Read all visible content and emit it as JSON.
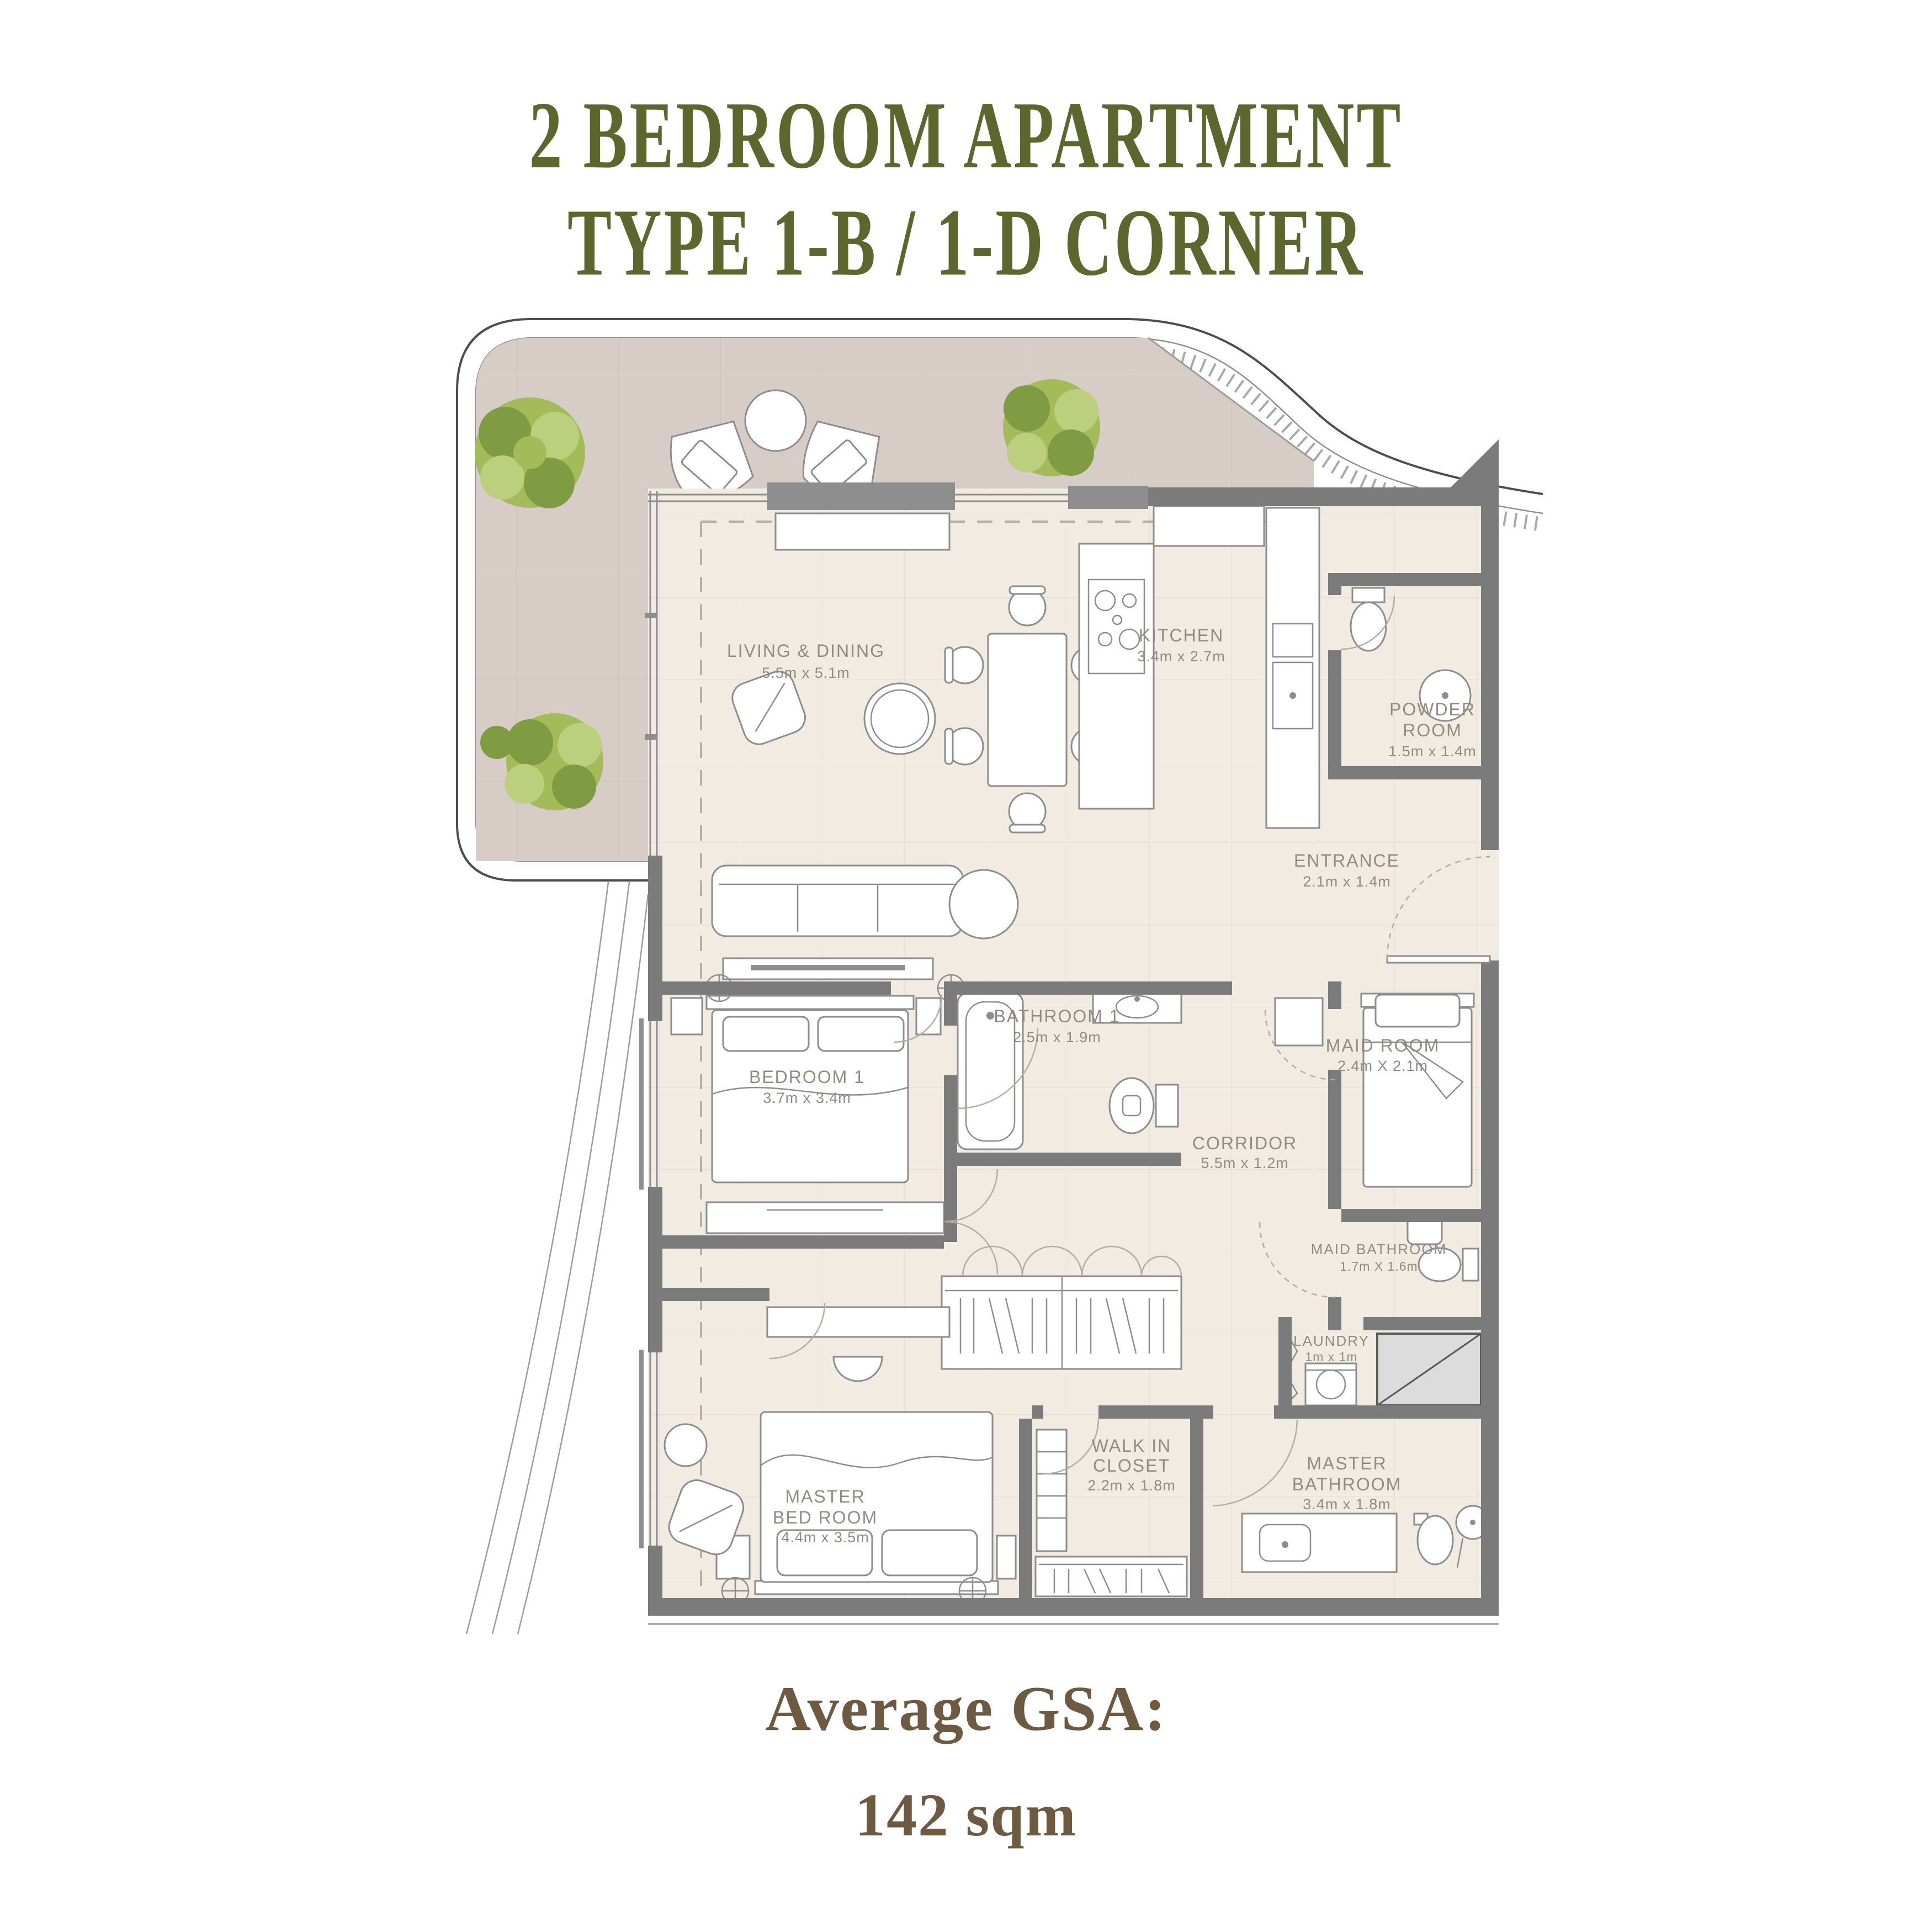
{
  "title": {
    "line1": "2 BEDROOM APARTMENT",
    "line2": "TYPE 1-B / 1-D CORNER"
  },
  "footer": {
    "label": "Average GSA:",
    "value": "142 sqm"
  },
  "rooms": [
    {
      "id": "living",
      "lines": [
        "LIVING & DINING"
      ],
      "dims": "5.5m x 5.1m"
    },
    {
      "id": "kitchen",
      "lines": [
        "KITCHEN"
      ],
      "dims": "3.4m x 2.7m"
    },
    {
      "id": "powder",
      "lines": [
        "POWDER",
        "ROOM"
      ],
      "dims": "1.5m x 1.4m"
    },
    {
      "id": "entrance",
      "lines": [
        "ENTRANCE"
      ],
      "dims": "2.1m x 1.4m"
    },
    {
      "id": "bathroom1",
      "lines": [
        "BATHROOM 1"
      ],
      "dims": "2.5m x 1.9m"
    },
    {
      "id": "bedroom1",
      "lines": [
        "BEDROOM 1"
      ],
      "dims": "3.7m x 3.4m"
    },
    {
      "id": "maidroom",
      "lines": [
        "MAID ROOM"
      ],
      "dims": "2.4m X 2.1m"
    },
    {
      "id": "corridor",
      "lines": [
        "CORRIDOR"
      ],
      "dims": "5.5m x 1.2m"
    },
    {
      "id": "maidbath",
      "lines": [
        "MAID BATHROOM"
      ],
      "dims": "1.7m X 1.6m"
    },
    {
      "id": "laundry",
      "lines": [
        "LAUNDRY"
      ],
      "dims": "1m x 1m"
    },
    {
      "id": "walkin",
      "lines": [
        "WALK IN",
        "CLOSET"
      ],
      "dims": "2.2m x 1.8m"
    },
    {
      "id": "masterbed",
      "lines": [
        "MASTER",
        "BED ROOM"
      ],
      "dims": "4.4m x 3.5m"
    },
    {
      "id": "masterbath",
      "lines": [
        "MASTER",
        "BATHROOM"
      ],
      "dims": "3.4m x 1.8m"
    }
  ],
  "colors": {
    "title_green": "#5c672e",
    "footer_brown": "#6e5a41",
    "wall_gray": "#7b7b7b",
    "floor_cream": "#f1ebe2",
    "terrace_taupe": "#d8cdc6",
    "tree_green": "#8fae4e",
    "label_gray": "#8f8c84"
  }
}
